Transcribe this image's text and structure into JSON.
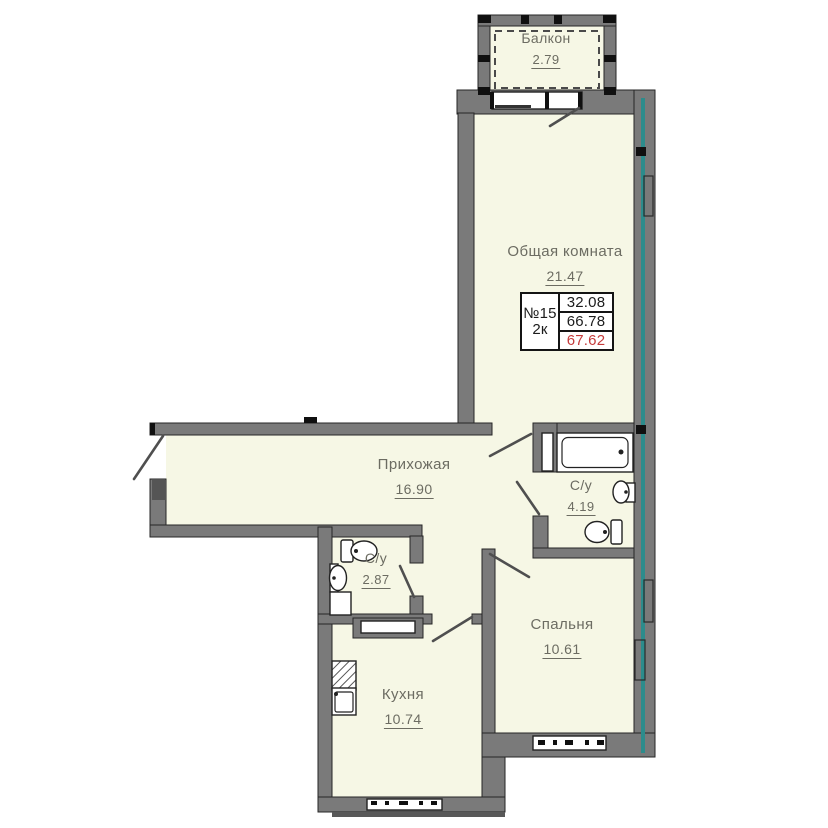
{
  "plan": {
    "unit_info": {
      "number": "№15",
      "type": "2к",
      "living_area": "32.08",
      "usable_area": "66.78",
      "total_area": "67.62"
    },
    "rooms": [
      {
        "key": "balcony",
        "label": "Балкон",
        "area": "2.79"
      },
      {
        "key": "living",
        "label": "Общая комната",
        "area": "21.47"
      },
      {
        "key": "hallway",
        "label": "Прихожая",
        "area": "16.90"
      },
      {
        "key": "bathroom",
        "label": "С/у",
        "area": "4.19"
      },
      {
        "key": "wc",
        "label": "С/у",
        "area": "2.87"
      },
      {
        "key": "bedroom",
        "label": "Спальня",
        "area": "10.61"
      },
      {
        "key": "kitchen",
        "label": "Кухня",
        "area": "10.74"
      }
    ],
    "colors": {
      "floor": "#f6f7e5",
      "walls": "#7a7a7a",
      "teal_accent": "#2c8c8c",
      "total_area_red": "#c53b3b"
    }
  }
}
